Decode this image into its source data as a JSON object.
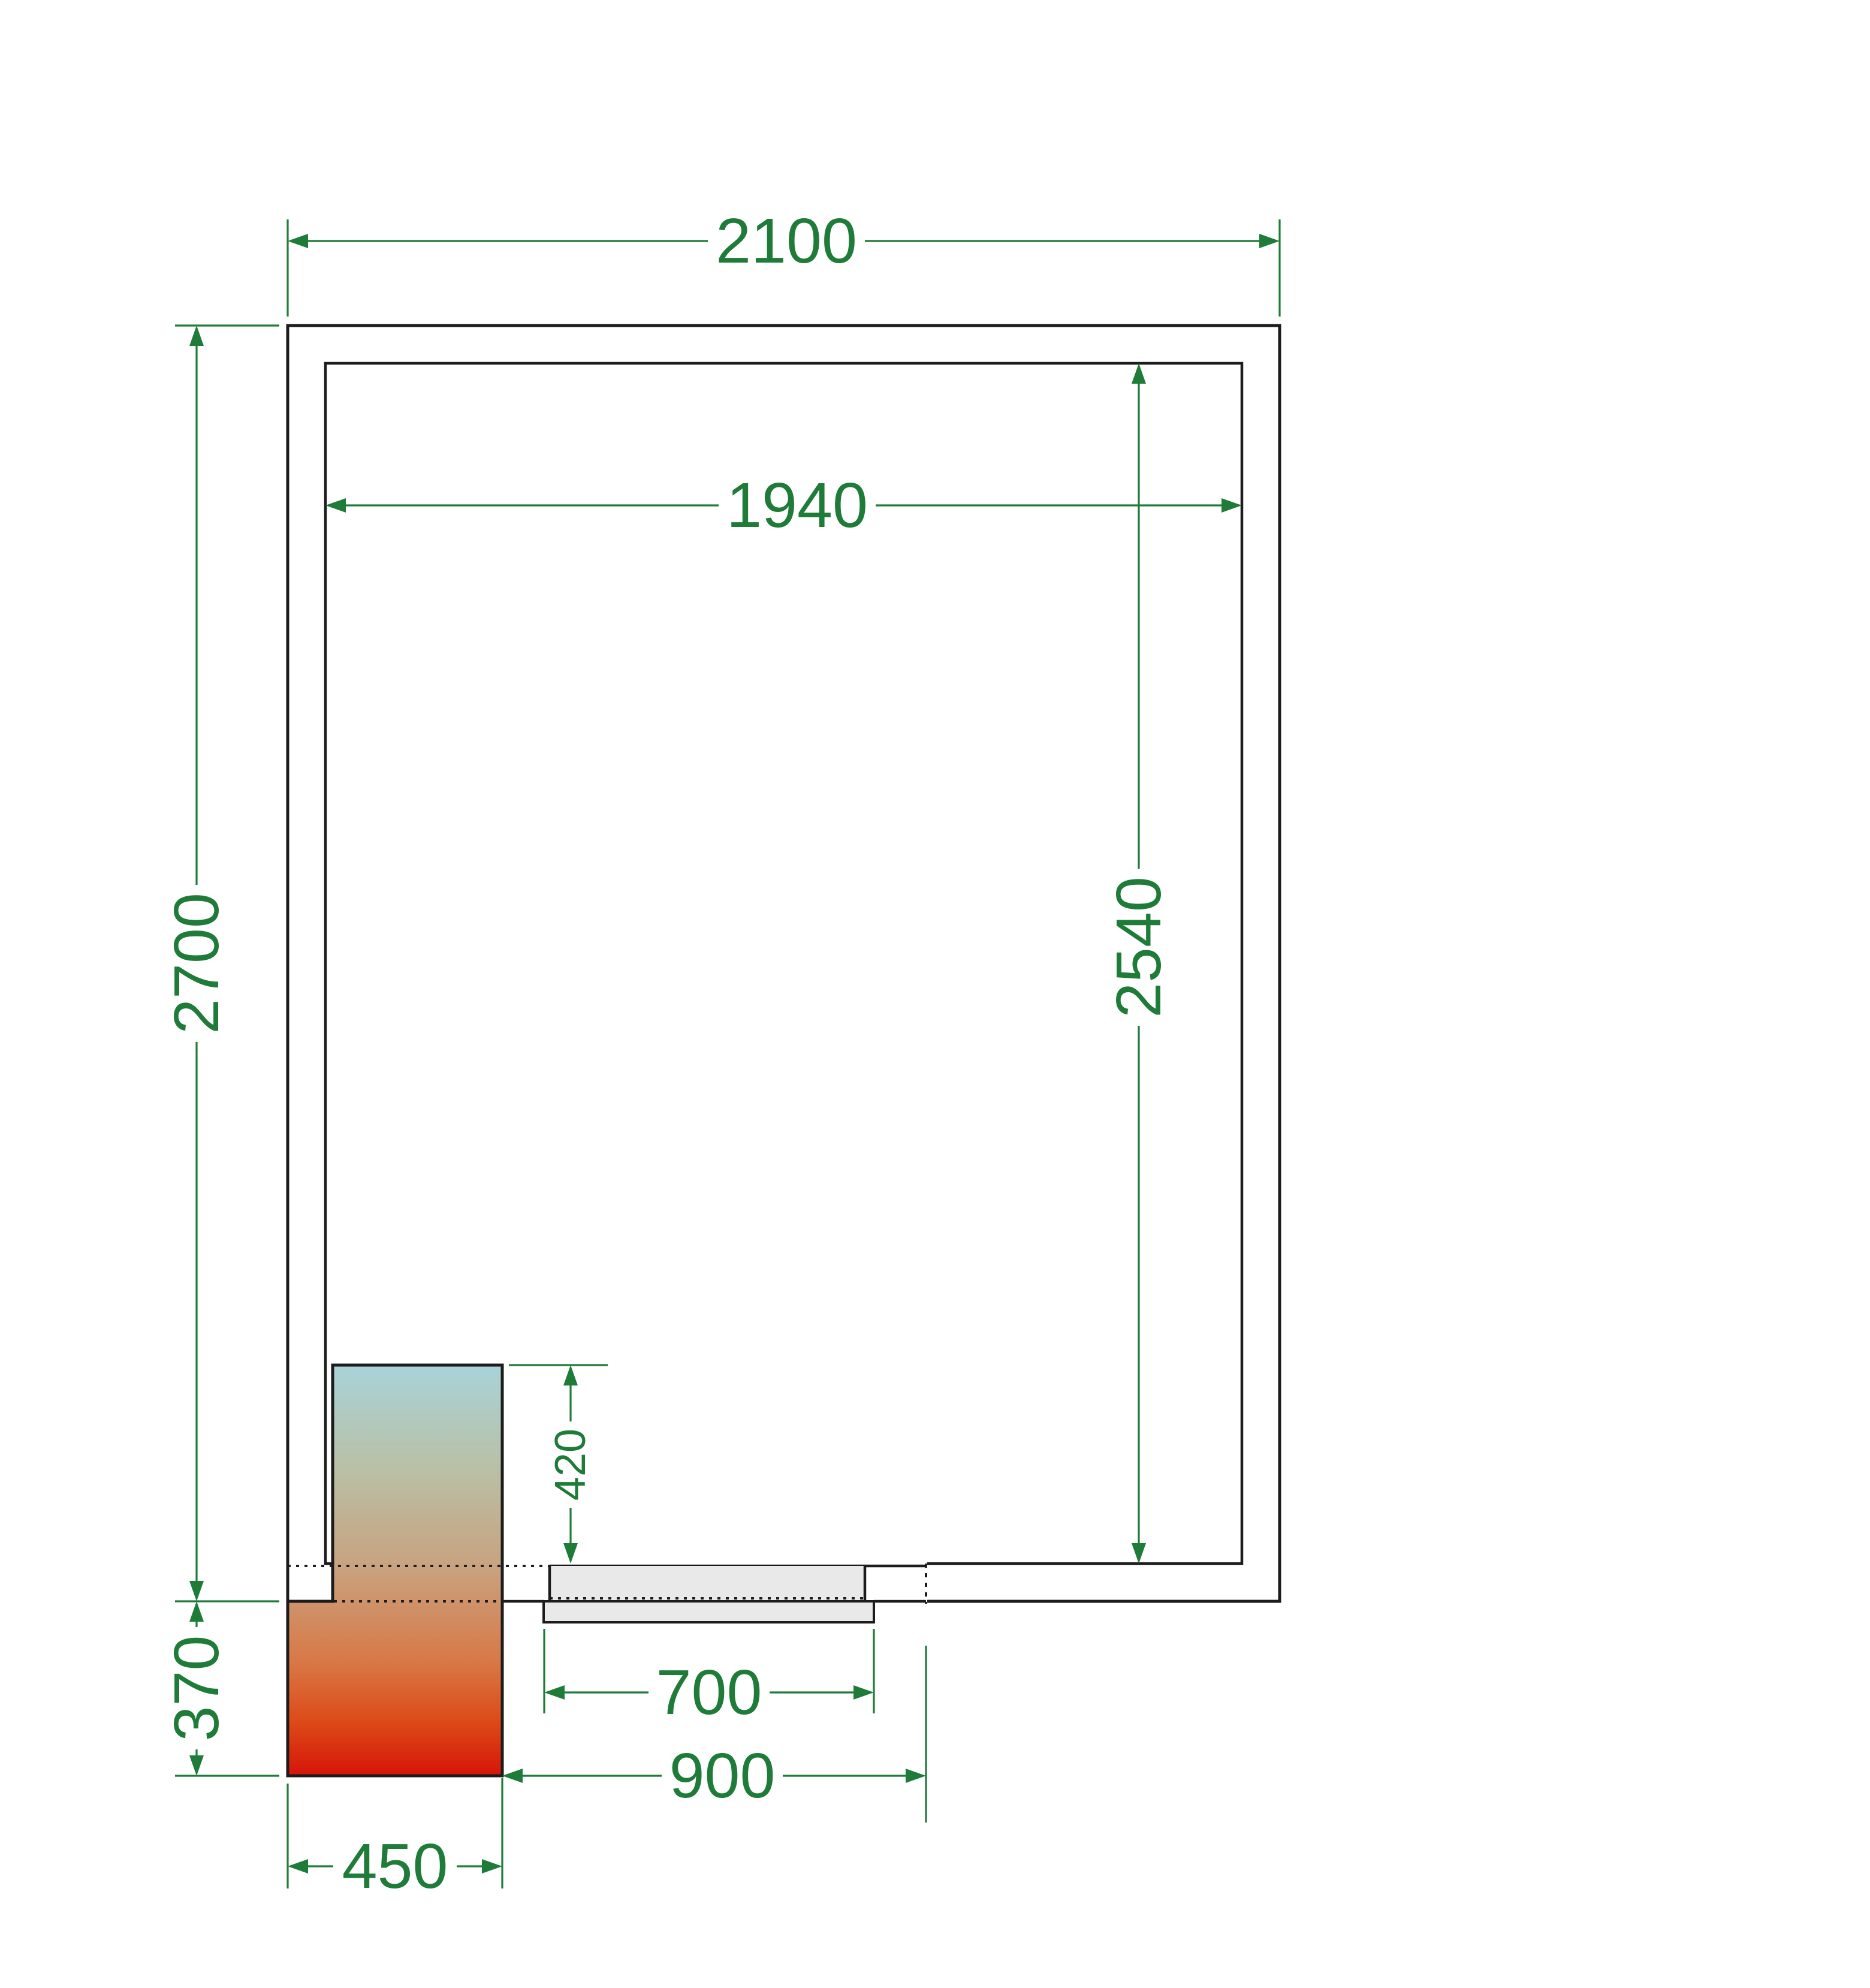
{
  "drawing": {
    "kind": "cold-room floor plan, top view",
    "dims": {
      "outer_width": "2100",
      "inner_width": "1940",
      "outer_depth": "2700",
      "inner_depth": "2540",
      "unit_inside_depth": "420",
      "unit_outside_depth": "370",
      "door_leaf_width": "700",
      "door_opening_width": "900",
      "unit_width": "450"
    }
  },
  "colors": {
    "dimension-green": "#1e7b38",
    "line-black": "#1c1c1c",
    "door-gray": "#e9e9e9",
    "paper-white": "#ffffff",
    "unit-top": "#a8d3d9",
    "unit-upper-mid": "#b9c0a6",
    "unit-mid": "#c9a17e",
    "unit-lower-mid": "#d87947",
    "unit-deep": "#dc4a17",
    "unit-bottom": "#d61509"
  }
}
